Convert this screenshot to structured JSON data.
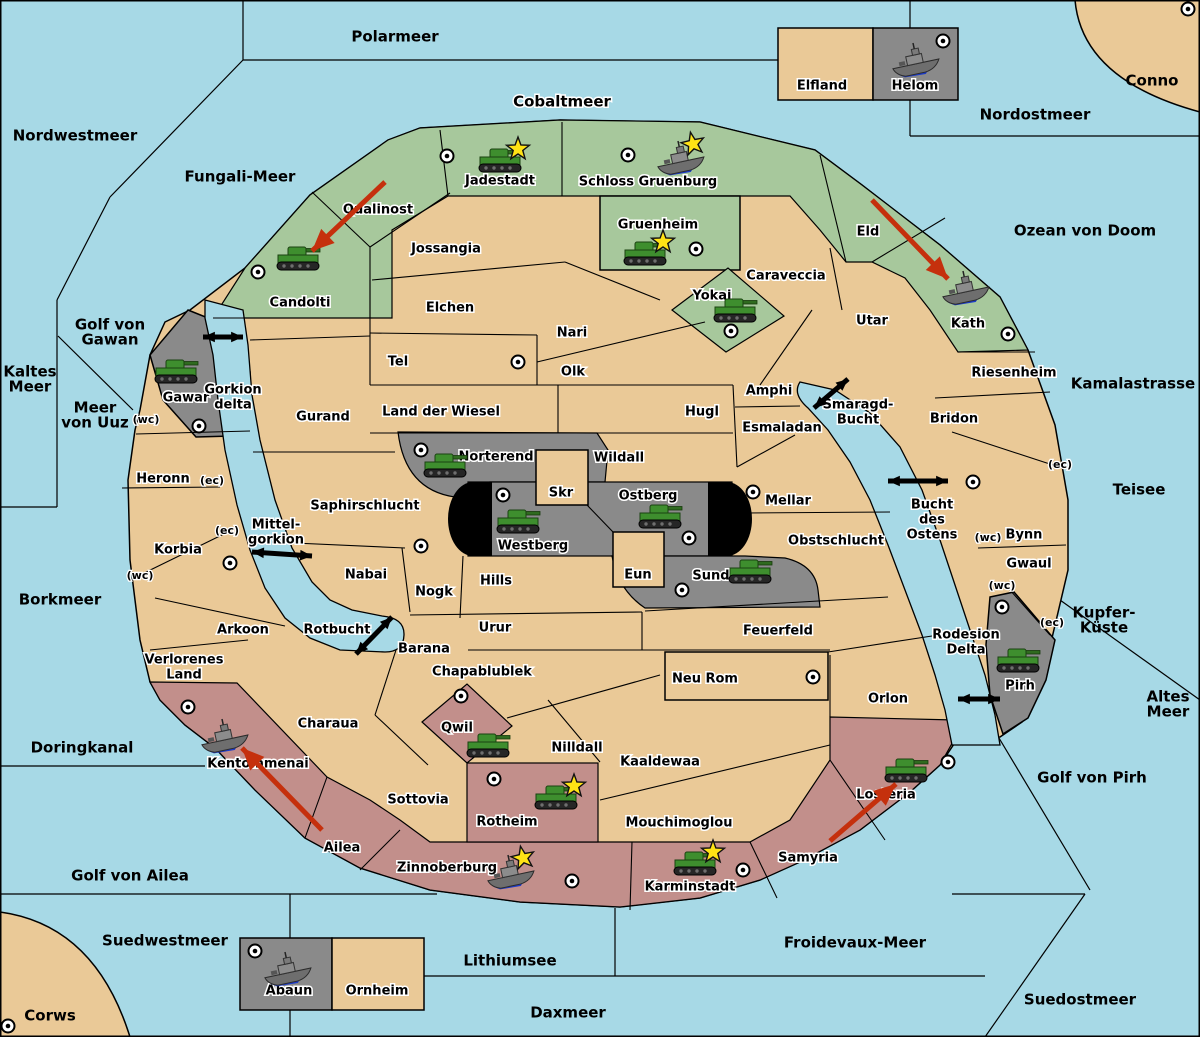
{
  "map_title": "Fantasy Diplomacy strategy map",
  "colors": {
    "sea": "#a7d9e6",
    "land": "#eac997",
    "north_power_green": "#a7c89c",
    "south_power_pink": "#c28f8b",
    "neutral_gray": "#8a8a8a",
    "impassable_black": "#000000",
    "move_arrow_red": "#c5300d",
    "unit_green": "#3e8e2e",
    "star_yellow": "#ffe315",
    "border": "#000000"
  },
  "labels": {
    "sea": [
      {
        "t": [
          "Polarmeer"
        ],
        "x": 395,
        "y": 37
      },
      {
        "t": [
          "Cobaltmeer"
        ],
        "x": 562,
        "y": 102,
        "halo": true
      },
      {
        "t": [
          "Nordwestmeer"
        ],
        "x": 75,
        "y": 136
      },
      {
        "t": [
          "Fungali-Meer"
        ],
        "x": 240,
        "y": 177
      },
      {
        "t": [
          "Nordostmeer"
        ],
        "x": 1035,
        "y": 115
      },
      {
        "t": [
          "Conno"
        ],
        "x": 1152,
        "y": 81
      },
      {
        "t": [
          "Ozean von Doom"
        ],
        "x": 1085,
        "y": 231
      },
      {
        "t": [
          "Golf von",
          "Gawan"
        ],
        "x": 110,
        "y": 325
      },
      {
        "t": [
          "Kaltes",
          "Meer"
        ],
        "x": 30,
        "y": 372
      },
      {
        "t": [
          "Meer",
          "von Uuz"
        ],
        "x": 95,
        "y": 408
      },
      {
        "t": [
          "Kamalastrasse"
        ],
        "x": 1133,
        "y": 384
      },
      {
        "t": [
          "Teisee"
        ],
        "x": 1139,
        "y": 490
      },
      {
        "t": [
          "Borkmeer"
        ],
        "x": 60,
        "y": 600
      },
      {
        "t": [
          "Kupfer-",
          "Küste"
        ],
        "x": 1104,
        "y": 613
      },
      {
        "t": [
          "Altes",
          "Meer"
        ],
        "x": 1168,
        "y": 697
      },
      {
        "t": [
          "Doringkanal"
        ],
        "x": 82,
        "y": 748
      },
      {
        "t": [
          "Golf von Pirh"
        ],
        "x": 1092,
        "y": 778
      },
      {
        "t": [
          "Golf von Ailea"
        ],
        "x": 130,
        "y": 876
      },
      {
        "t": [
          "Suedwestmeer"
        ],
        "x": 165,
        "y": 941
      },
      {
        "t": [
          "Froidevaux-Meer"
        ],
        "x": 855,
        "y": 943
      },
      {
        "t": [
          "Lithiumsee"
        ],
        "x": 510,
        "y": 961
      },
      {
        "t": [
          "Daxmeer"
        ],
        "x": 568,
        "y": 1013
      },
      {
        "t": [
          "Suedostmeer"
        ],
        "x": 1080,
        "y": 1000
      },
      {
        "t": [
          "Corws"
        ],
        "x": 50,
        "y": 1016
      }
    ],
    "territories": [
      {
        "t": [
          "Qualinost"
        ],
        "x": 378,
        "y": 210
      },
      {
        "t": [
          "Jadestadt"
        ],
        "x": 500,
        "y": 181
      },
      {
        "t": [
          "Schloss Gruenburg"
        ],
        "x": 648,
        "y": 182
      },
      {
        "t": [
          "Gruenheim"
        ],
        "x": 658,
        "y": 225
      },
      {
        "t": [
          "Yokai"
        ],
        "x": 712,
        "y": 296
      },
      {
        "t": [
          "Candolti"
        ],
        "x": 300,
        "y": 303
      },
      {
        "t": [
          "Eld"
        ],
        "x": 868,
        "y": 232
      },
      {
        "t": [
          "Kath"
        ],
        "x": 968,
        "y": 324
      },
      {
        "t": [
          "Caraveccia"
        ],
        "x": 786,
        "y": 276
      },
      {
        "t": [
          "Jossangia"
        ],
        "x": 446,
        "y": 249
      },
      {
        "t": [
          "Elchen"
        ],
        "x": 450,
        "y": 308
      },
      {
        "t": [
          "Nari"
        ],
        "x": 572,
        "y": 333
      },
      {
        "t": [
          "Olk"
        ],
        "x": 573,
        "y": 372
      },
      {
        "t": [
          "Tel"
        ],
        "x": 398,
        "y": 362
      },
      {
        "t": [
          "Land der Wiesel"
        ],
        "x": 441,
        "y": 412
      },
      {
        "t": [
          "Gurand"
        ],
        "x": 323,
        "y": 417
      },
      {
        "t": [
          "Hugl"
        ],
        "x": 702,
        "y": 412
      },
      {
        "t": [
          "Amphi"
        ],
        "x": 769,
        "y": 391
      },
      {
        "t": [
          "Esmaladan"
        ],
        "x": 782,
        "y": 428
      },
      {
        "t": [
          "Utar"
        ],
        "x": 872,
        "y": 321
      },
      {
        "t": [
          "Riesenheim"
        ],
        "x": 1014,
        "y": 373
      },
      {
        "t": [
          "Bridon"
        ],
        "x": 954,
        "y": 419
      },
      {
        "t": [
          "Bynn"
        ],
        "x": 1024,
        "y": 535
      },
      {
        "t": [
          "Gwaul"
        ],
        "x": 1029,
        "y": 564
      },
      {
        "t": [
          "Gawar"
        ],
        "x": 186,
        "y": 398
      },
      {
        "t": [
          "Heronn"
        ],
        "x": 163,
        "y": 479
      },
      {
        "t": [
          "Korbia"
        ],
        "x": 178,
        "y": 550
      },
      {
        "t": [
          "Arkoon"
        ],
        "x": 243,
        "y": 630
      },
      {
        "t": [
          "Verlorenes",
          "Land"
        ],
        "x": 184,
        "y": 660
      },
      {
        "t": [
          "Saphirschlucht"
        ],
        "x": 365,
        "y": 506
      },
      {
        "t": [
          "Nabai"
        ],
        "x": 366,
        "y": 575
      },
      {
        "t": [
          "Nogk"
        ],
        "x": 434,
        "y": 592
      },
      {
        "t": [
          "Hills"
        ],
        "x": 496,
        "y": 581
      },
      {
        "t": [
          "Skr"
        ],
        "x": 561,
        "y": 493
      },
      {
        "t": [
          "Wildall"
        ],
        "x": 619,
        "y": 458
      },
      {
        "t": [
          "Norterend"
        ],
        "x": 496,
        "y": 457
      },
      {
        "t": [
          "Westberg"
        ],
        "x": 533,
        "y": 546
      },
      {
        "t": [
          "Ostberg"
        ],
        "x": 648,
        "y": 496
      },
      {
        "t": [
          "Eun"
        ],
        "x": 638,
        "y": 575
      },
      {
        "t": [
          "Sund"
        ],
        "x": 711,
        "y": 576
      },
      {
        "t": [
          "Mellar"
        ],
        "x": 788,
        "y": 501
      },
      {
        "t": [
          "Obstschlucht"
        ],
        "x": 836,
        "y": 541
      },
      {
        "t": [
          "Urur"
        ],
        "x": 495,
        "y": 628
      },
      {
        "t": [
          "Feuerfeld"
        ],
        "x": 778,
        "y": 631
      },
      {
        "t": [
          "Barana"
        ],
        "x": 424,
        "y": 649
      },
      {
        "t": [
          "Chapablublek"
        ],
        "x": 482,
        "y": 672
      },
      {
        "t": [
          "Neu Rom"
        ],
        "x": 705,
        "y": 679
      },
      {
        "t": [
          "Kaaldewaa"
        ],
        "x": 660,
        "y": 762
      },
      {
        "t": [
          "Nilldall"
        ],
        "x": 577,
        "y": 748
      },
      {
        "t": [
          "Qwil"
        ],
        "x": 457,
        "y": 728
      },
      {
        "t": [
          "Rotheim"
        ],
        "x": 507,
        "y": 822
      },
      {
        "t": [
          "Sottovia"
        ],
        "x": 418,
        "y": 800
      },
      {
        "t": [
          "Mouchimoglou"
        ],
        "x": 679,
        "y": 823
      },
      {
        "t": [
          "Charaua"
        ],
        "x": 328,
        "y": 724
      },
      {
        "t": [
          "Kentommenai"
        ],
        "x": 258,
        "y": 764
      },
      {
        "t": [
          "Ailea"
        ],
        "x": 342,
        "y": 848
      },
      {
        "t": [
          "Zinnoberburg"
        ],
        "x": 447,
        "y": 868
      },
      {
        "t": [
          "Karminstadt"
        ],
        "x": 690,
        "y": 887
      },
      {
        "t": [
          "Samyria"
        ],
        "x": 808,
        "y": 858
      },
      {
        "t": [
          "Losteria"
        ],
        "x": 886,
        "y": 795
      },
      {
        "t": [
          "Orlon"
        ],
        "x": 888,
        "y": 699
      },
      {
        "t": [
          "Pirh"
        ],
        "x": 1020,
        "y": 686
      },
      {
        "t": [
          "Elfland"
        ],
        "x": 822,
        "y": 86
      },
      {
        "t": [
          "Helom"
        ],
        "x": 915,
        "y": 86
      },
      {
        "t": [
          "Abaun"
        ],
        "x": 289,
        "y": 991
      },
      {
        "t": [
          "Ornheim"
        ],
        "x": 377,
        "y": 991
      },
      {
        "t": [
          "Gorkion",
          "delta"
        ],
        "x": 233,
        "y": 390
      },
      {
        "t": [
          "Mittel-",
          "gorkion"
        ],
        "x": 276,
        "y": 525
      },
      {
        "t": [
          "Rotbucht"
        ],
        "x": 337,
        "y": 630
      },
      {
        "t": [
          "Smaragd-",
          "Bucht"
        ],
        "x": 858,
        "y": 405
      },
      {
        "t": [
          "Bucht",
          "des",
          "Ostens"
        ],
        "x": 932,
        "y": 505
      },
      {
        "t": [
          "Rodesion",
          "Delta"
        ],
        "x": 966,
        "y": 635
      }
    ],
    "coasts": [
      {
        "t": "(wc)",
        "x": 146,
        "y": 420
      },
      {
        "t": "(ec)",
        "x": 212,
        "y": 481
      },
      {
        "t": "(ec)",
        "x": 227,
        "y": 531
      },
      {
        "t": "(wc)",
        "x": 140,
        "y": 576
      },
      {
        "t": "(ec)",
        "x": 1060,
        "y": 465
      },
      {
        "t": "(wc)",
        "x": 988,
        "y": 538
      },
      {
        "t": "(wc)",
        "x": 1002,
        "y": 586
      },
      {
        "t": "(ec)",
        "x": 1052,
        "y": 623
      }
    ]
  },
  "supply_centers": [
    {
      "at": "Candolti",
      "x": 258,
      "y": 272
    },
    {
      "at": "Jadestadt",
      "x": 447,
      "y": 156
    },
    {
      "at": "Schloss Gruenburg",
      "x": 628,
      "y": 155
    },
    {
      "at": "Gruenheim",
      "x": 696,
      "y": 249
    },
    {
      "at": "Yokai",
      "x": 731,
      "y": 331
    },
    {
      "at": "Helom",
      "x": 943,
      "y": 41
    },
    {
      "at": "Conno",
      "x": 1188,
      "y": 9
    },
    {
      "at": "Kath",
      "x": 1008,
      "y": 334
    },
    {
      "at": "Gawar",
      "x": 199,
      "y": 426
    },
    {
      "at": "Tel",
      "x": 518,
      "y": 362
    },
    {
      "at": "Norterend",
      "x": 421,
      "y": 450
    },
    {
      "at": "Westberg",
      "x": 503,
      "y": 495
    },
    {
      "at": "Ostberg",
      "x": 689,
      "y": 538
    },
    {
      "at": "Mellar",
      "x": 753,
      "y": 492
    },
    {
      "at": "Saphirschlucht",
      "x": 421,
      "y": 546
    },
    {
      "at": "Korbia",
      "x": 230,
      "y": 563
    },
    {
      "at": "Sund",
      "x": 682,
      "y": 590
    },
    {
      "at": "Bynn",
      "x": 973,
      "y": 482
    },
    {
      "at": "Pirh",
      "x": 1002,
      "y": 607
    },
    {
      "at": "Neu Rom",
      "x": 813,
      "y": 677
    },
    {
      "at": "Qwil",
      "x": 461,
      "y": 696
    },
    {
      "at": "Kentommenai",
      "x": 188,
      "y": 707
    },
    {
      "at": "Losteria",
      "x": 948,
      "y": 762
    },
    {
      "at": "Rotheim",
      "x": 494,
      "y": 779
    },
    {
      "at": "Zinnoberburg",
      "x": 572,
      "y": 881
    },
    {
      "at": "Karminstadt",
      "x": 743,
      "y": 870
    },
    {
      "at": "Abaun",
      "x": 255,
      "y": 951
    },
    {
      "at": "Corws",
      "x": 8,
      "y": 1026
    }
  ],
  "units": [
    {
      "kind": "army",
      "at": "Jadestadt",
      "x": 500,
      "y": 163,
      "star": true
    },
    {
      "kind": "fleet",
      "at": "Schloss Gruenburg",
      "x": 680,
      "y": 160,
      "star": true
    },
    {
      "kind": "army",
      "at": "Gruenheim",
      "x": 645,
      "y": 256,
      "star": true
    },
    {
      "kind": "army",
      "at": "Yokai",
      "x": 735,
      "y": 313,
      "star": false
    },
    {
      "kind": "army",
      "at": "Candolti",
      "x": 298,
      "y": 261,
      "star": false
    },
    {
      "kind": "fleet",
      "at": "Kath",
      "x": 965,
      "y": 290,
      "star": false
    },
    {
      "kind": "army",
      "at": "Gawar",
      "x": 176,
      "y": 374,
      "star": false
    },
    {
      "kind": "army",
      "at": "Norterend",
      "x": 445,
      "y": 468,
      "star": false
    },
    {
      "kind": "army",
      "at": "Westberg",
      "x": 518,
      "y": 524,
      "star": false
    },
    {
      "kind": "army",
      "at": "Ostberg",
      "x": 660,
      "y": 519,
      "star": false
    },
    {
      "kind": "army",
      "at": "Sund",
      "x": 750,
      "y": 574,
      "star": false
    },
    {
      "kind": "army",
      "at": "Pirh",
      "x": 1018,
      "y": 663,
      "star": false
    },
    {
      "kind": "army",
      "at": "Qwil",
      "x": 488,
      "y": 748,
      "star": false
    },
    {
      "kind": "army",
      "at": "Rotheim",
      "x": 556,
      "y": 800,
      "star": true
    },
    {
      "kind": "fleet",
      "at": "Kentommenai",
      "x": 224,
      "y": 738,
      "star": false
    },
    {
      "kind": "fleet",
      "at": "Zinnoberburg",
      "x": 510,
      "y": 874,
      "star": true
    },
    {
      "kind": "army",
      "at": "Karminstadt",
      "x": 695,
      "y": 866,
      "star": true
    },
    {
      "kind": "army",
      "at": "Losteria",
      "x": 906,
      "y": 773,
      "star": false
    },
    {
      "kind": "fleet",
      "at": "Helom",
      "x": 915,
      "y": 62,
      "star": false
    },
    {
      "kind": "fleet",
      "at": "Abaun",
      "x": 287,
      "y": 971,
      "star": false
    }
  ],
  "move_arrows": [
    {
      "from": "Qualinost",
      "to": "Candolti",
      "x1": 385,
      "y1": 182,
      "x2": 312,
      "y2": 251
    },
    {
      "from": "Eld",
      "to": "Kath",
      "x1": 872,
      "y1": 200,
      "x2": 948,
      "y2": 279
    },
    {
      "from": "Ailea",
      "to": "Kentommenai",
      "x1": 322,
      "y1": 830,
      "x2": 242,
      "y2": 748
    },
    {
      "from": "Samyria",
      "to": "Losteria",
      "x1": 830,
      "y1": 841,
      "x2": 896,
      "y2": 784
    }
  ],
  "link_arrows": [
    {
      "x1": 203,
      "y1": 337,
      "x2": 243,
      "y2": 337
    },
    {
      "x1": 252,
      "y1": 552,
      "x2": 312,
      "y2": 556
    },
    {
      "x1": 356,
      "y1": 654,
      "x2": 392,
      "y2": 617
    },
    {
      "x1": 814,
      "y1": 408,
      "x2": 848,
      "y2": 379
    },
    {
      "x1": 888,
      "y1": 481,
      "x2": 948,
      "y2": 481
    },
    {
      "x1": 958,
      "y1": 699,
      "x2": 1000,
      "y2": 699
    }
  ]
}
